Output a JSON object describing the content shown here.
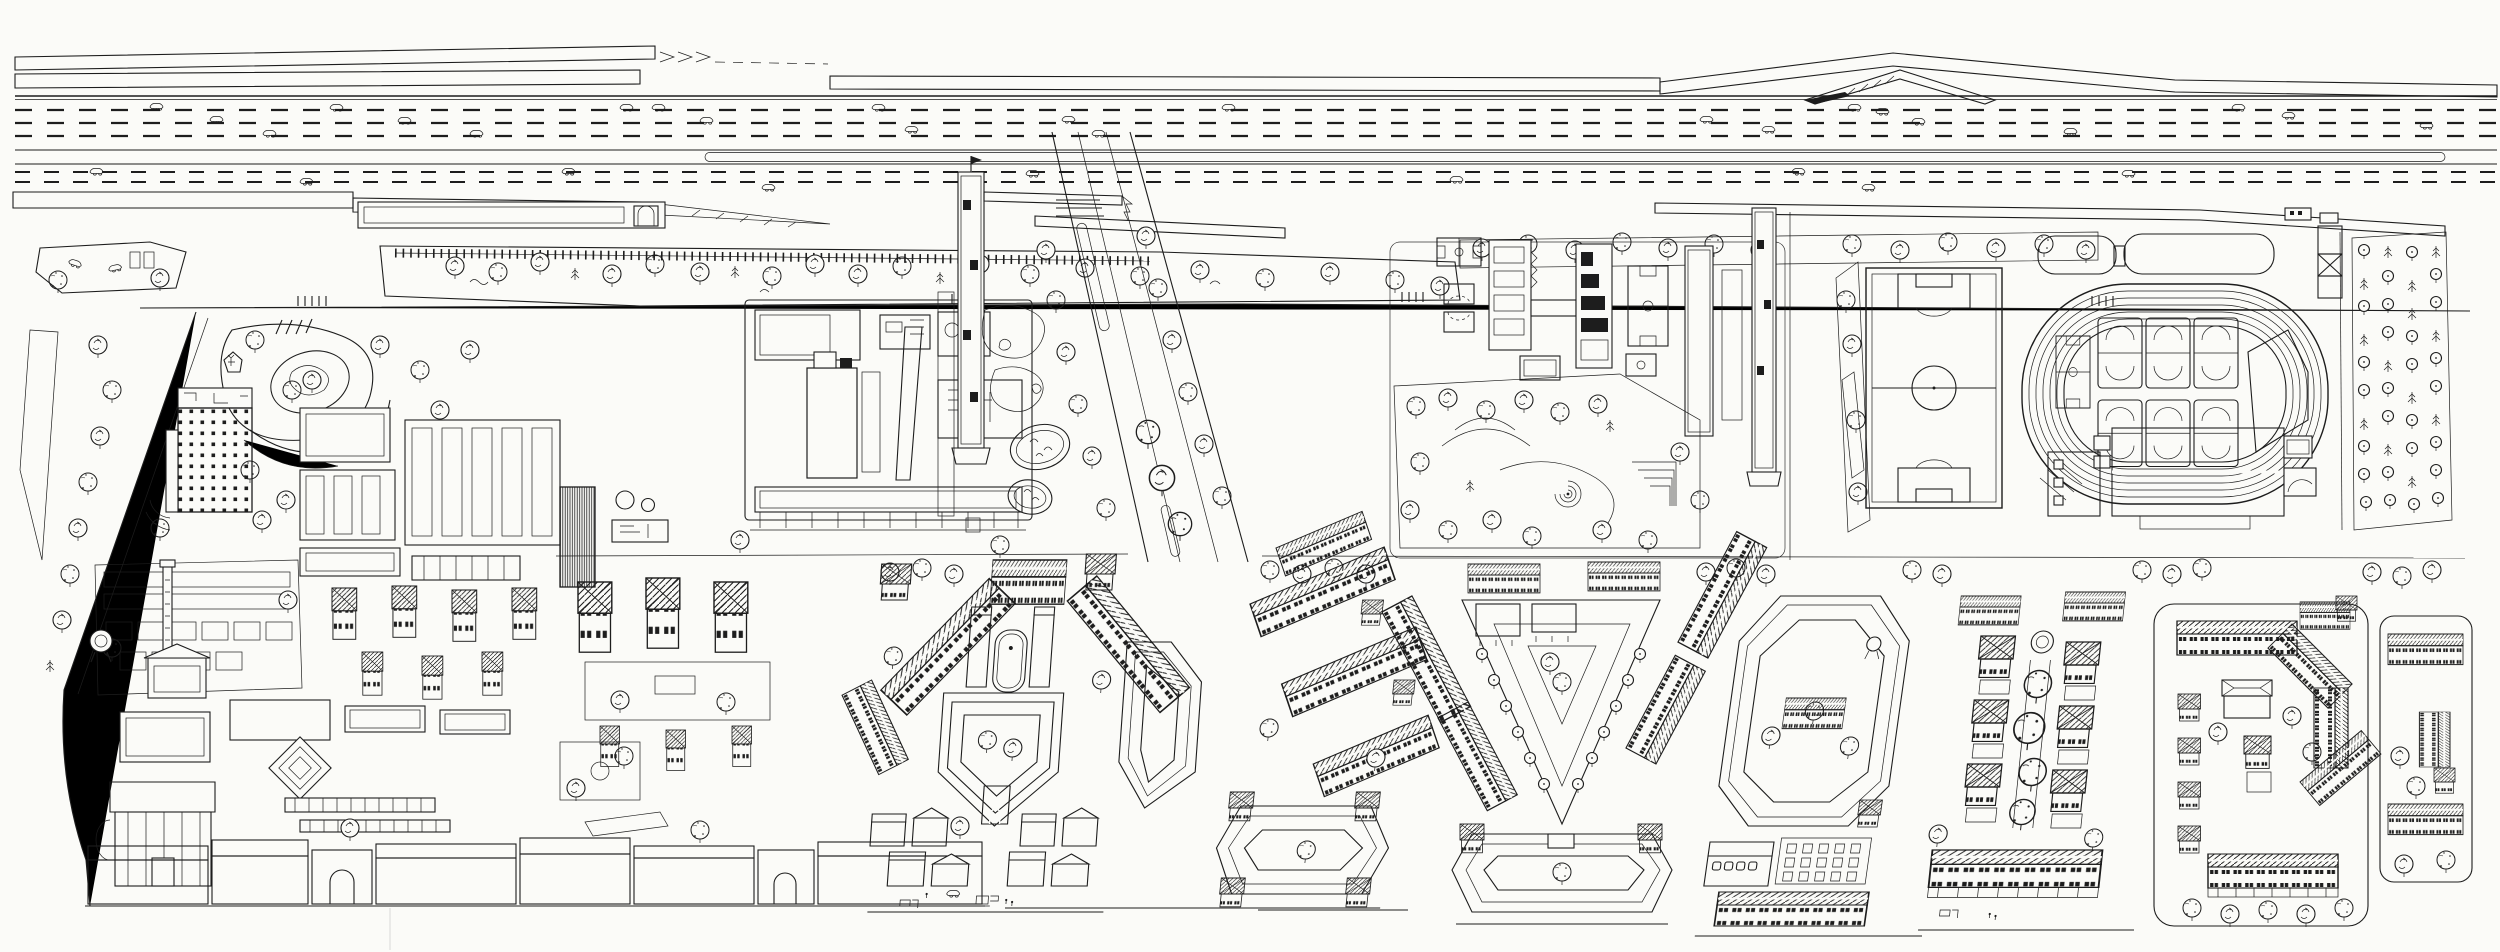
{
  "document": {
    "kind": "hand-drawn axonometric urban district plan",
    "medium": "black ink line drawing on white paper",
    "text_content_visible": "none"
  },
  "theme": {
    "paper": "#fbfbf8",
    "ink": "#1d1d1d",
    "faint": "#d8d8d8"
  },
  "regions": {
    "noise_barrier": "segmented noise-barrier ribbons along the elevated expressway",
    "expressway": "multi-lane expressway with dashed lane markings and scattered cars",
    "median": "central median strip with rounded island",
    "service_band": "lower barrier band with porthole panels and tapering hatched ramp",
    "meadow": "wild meadow embankment with rail siding, rocks and trees",
    "frontage_road": "frontage road with crosswalks",
    "industrial_campus": "factory campus with striped-roof halls, yards and plant equipment",
    "park_pond": "landscaped park with pond, island and winding paths",
    "residential_slab": "high-rise housing slab with dense window grid and roof plan",
    "boulevard": "tree-lined diagonal boulevard crossing the site",
    "watchtower": "slender lattice tower beside the boulevard",
    "footbridge": "hatched pedestrian bridge over the boulevard",
    "allotments": "garden plots with rockery and two oval planted ponds",
    "school": "school campus with basketball courts, classroom wings and play park",
    "spiral": "spiral labyrinth in the schoolyard park",
    "tower2": "second slender tower by the school",
    "soccer": "full-size soccer pitch with markings",
    "track": "six-lane running track with infield court cluster",
    "canopies": "striped grandstand canopies north of the track",
    "checker_tower": "small cross-braced tower at the sports ground",
    "gym": "ribbed-roof gymnasium hall south of the track",
    "orchard": "orchard grid of young trees on dotted ground",
    "old_quarter": "old factory quarter with chimney, water tower, sheds and tower houses",
    "street_row": "continuous street-front row of old houses with arched gates",
    "ensemble": "symmetric central housing ensemble with plaza, pool and gate block",
    "stepped_block": "echelon rows of gable-roof housing slabs",
    "triangle_park": "triangular park with pergolas and converging tree alleys",
    "hexagon_block": "hexagonal perimeter housing block with parterre garden and shops",
    "pavilion_block": "paired rows of pavilion-roof point blocks around a green axis",
    "east_block": "rounded-corner perimeter block with courtyard towers",
    "east_wedge": "narrow eastern housing strip",
    "corridor_trees": "tree row along the central east-west walkway",
    "left_edge": "western boundary lane with allotment wedge and tree line"
  }
}
